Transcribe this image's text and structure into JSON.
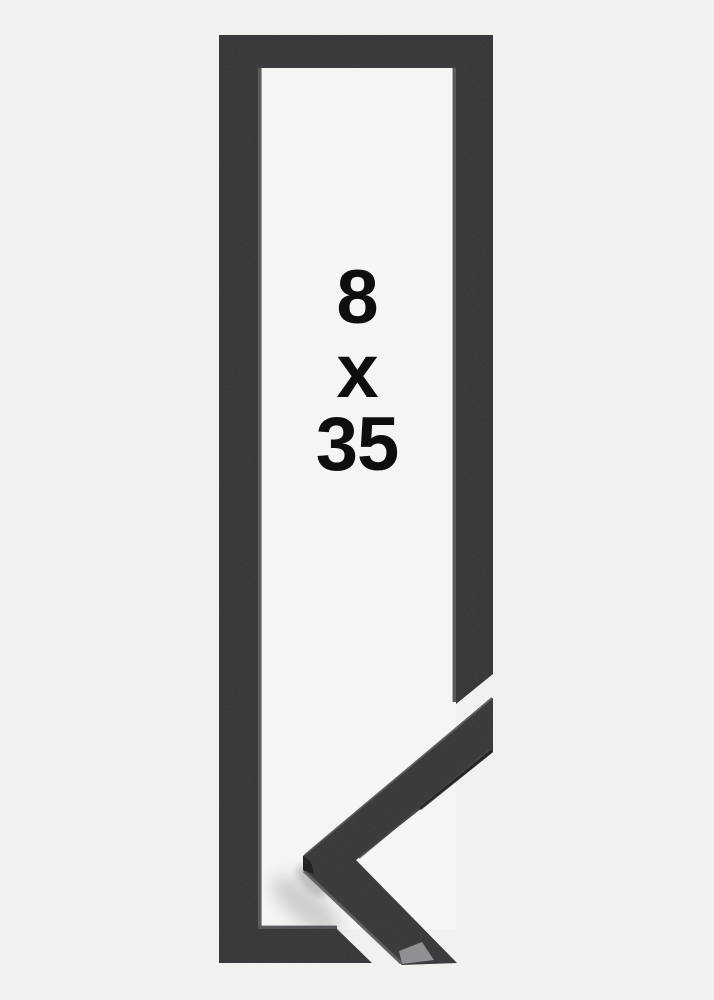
{
  "product_image": {
    "size_label": {
      "width": "8",
      "separator": "x",
      "height": "35"
    }
  },
  "colors": {
    "background": "#f1f1ef",
    "opening_background": "#f5f5f4",
    "frame": "#2b2b2d",
    "moulding_profile": "#2d2d2f",
    "miter_face": "#909094",
    "label_text": "#0e0e0e"
  }
}
